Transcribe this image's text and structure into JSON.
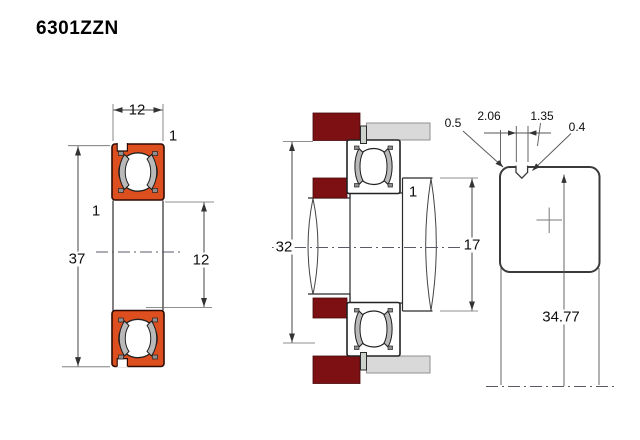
{
  "title": "6301ZZN",
  "front_view": {
    "width": "12",
    "outer_diameter": "37",
    "bore_diameter": "12",
    "outer_chamfer": "1",
    "inner_chamfer": "1"
  },
  "mounted_view": {
    "housing_shoulder_diameter": "32",
    "shaft_shoulder_diameter": "17",
    "shoulder_fillet": "1"
  },
  "groove_detail": {
    "corner_radius": "0.5",
    "groove_offset": "2.06",
    "groove_width": "1.35",
    "edge_chamfer": "0.4",
    "snap_ring_groove_diameter": "34.77"
  },
  "colors": {
    "seal_orange": "#dd4f1e",
    "housing_maroon": "#7c1013",
    "spacer_gray": "#d9d9d9",
    "snap_ring": "#ccd2cc",
    "line": "#2a2a2a"
  }
}
